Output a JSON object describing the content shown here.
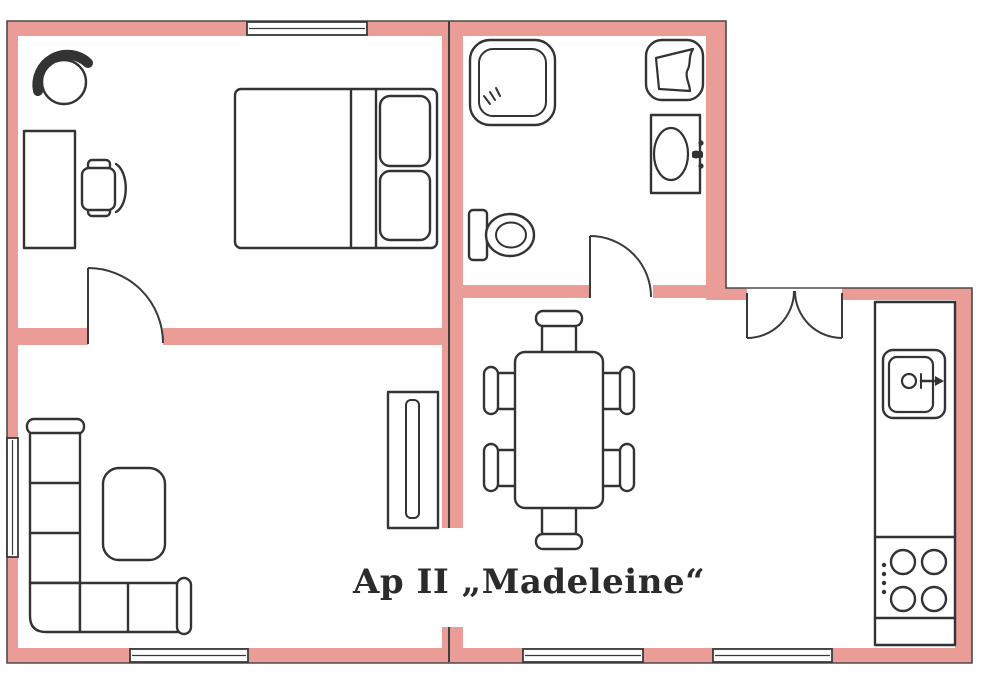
{
  "title": {
    "label": "Ap II „Madeleine“"
  },
  "palette": {
    "wall": "#ea9c96",
    "wall-outline": "#4a4a4a",
    "furniture-line": "#333333",
    "background": "#ffffff",
    "text": "#2b2b2b"
  },
  "rooms": [
    {
      "id": "bedroom",
      "furniture": [
        "armchair",
        "desk",
        "office-chair",
        "double-bed",
        "pillows"
      ]
    },
    {
      "id": "bathroom",
      "furniture": [
        "shower",
        "laundry-basket",
        "washbasin",
        "toilet"
      ]
    },
    {
      "id": "living-room",
      "furniture": [
        "corner-sofa",
        "coffee-table",
        "tv-sideboard"
      ]
    },
    {
      "id": "dining-area",
      "furniture": [
        "dining-table",
        "dining-chairs"
      ]
    },
    {
      "id": "kitchen",
      "furniture": [
        "kitchen-counter",
        "kitchen-sink",
        "faucet",
        "stove-burners"
      ]
    }
  ]
}
